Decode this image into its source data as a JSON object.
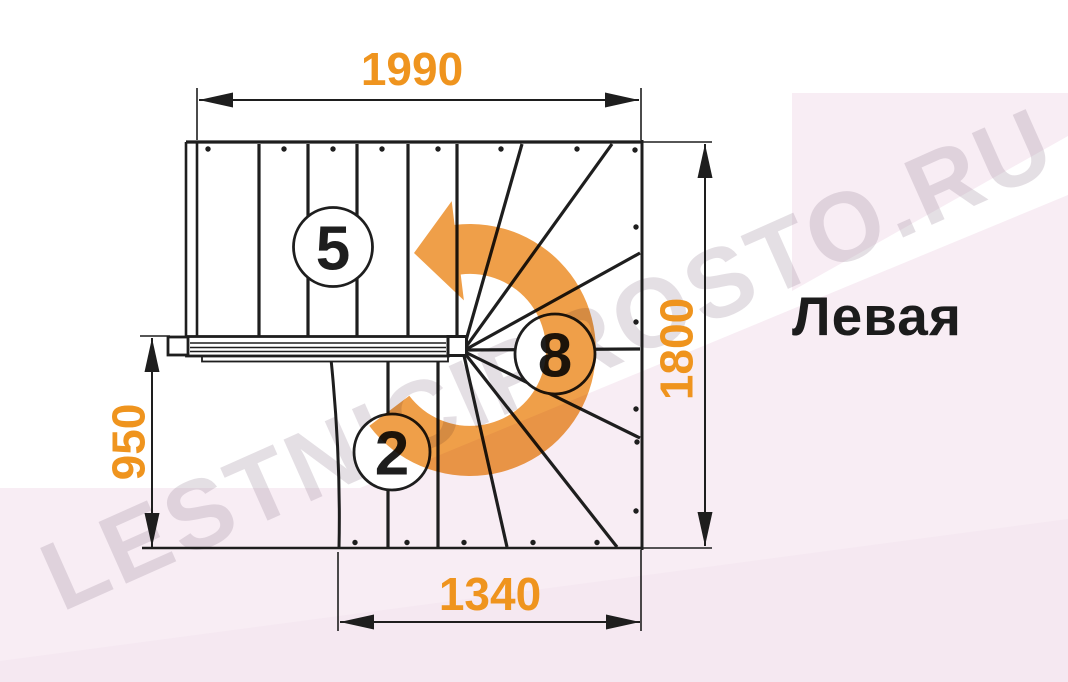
{
  "title": {
    "text": "Левая"
  },
  "watermark": {
    "text": "LESTNICIPROSTO.RU"
  },
  "dimensions": {
    "top_width": "1990",
    "right_height": "1800",
    "left_height": "950",
    "bottom_width": "1340"
  },
  "steps": {
    "upper_flight_count": "5",
    "winder_count": "8",
    "lower_flight_count": "2"
  },
  "colors": {
    "dimension_orange": "#EF941E",
    "arrow_orange": "#EF9F49",
    "line_black": "#1E1E1E",
    "background_pink": "#F8EDF4",
    "background_pink_deep": "#F3E4EE"
  }
}
